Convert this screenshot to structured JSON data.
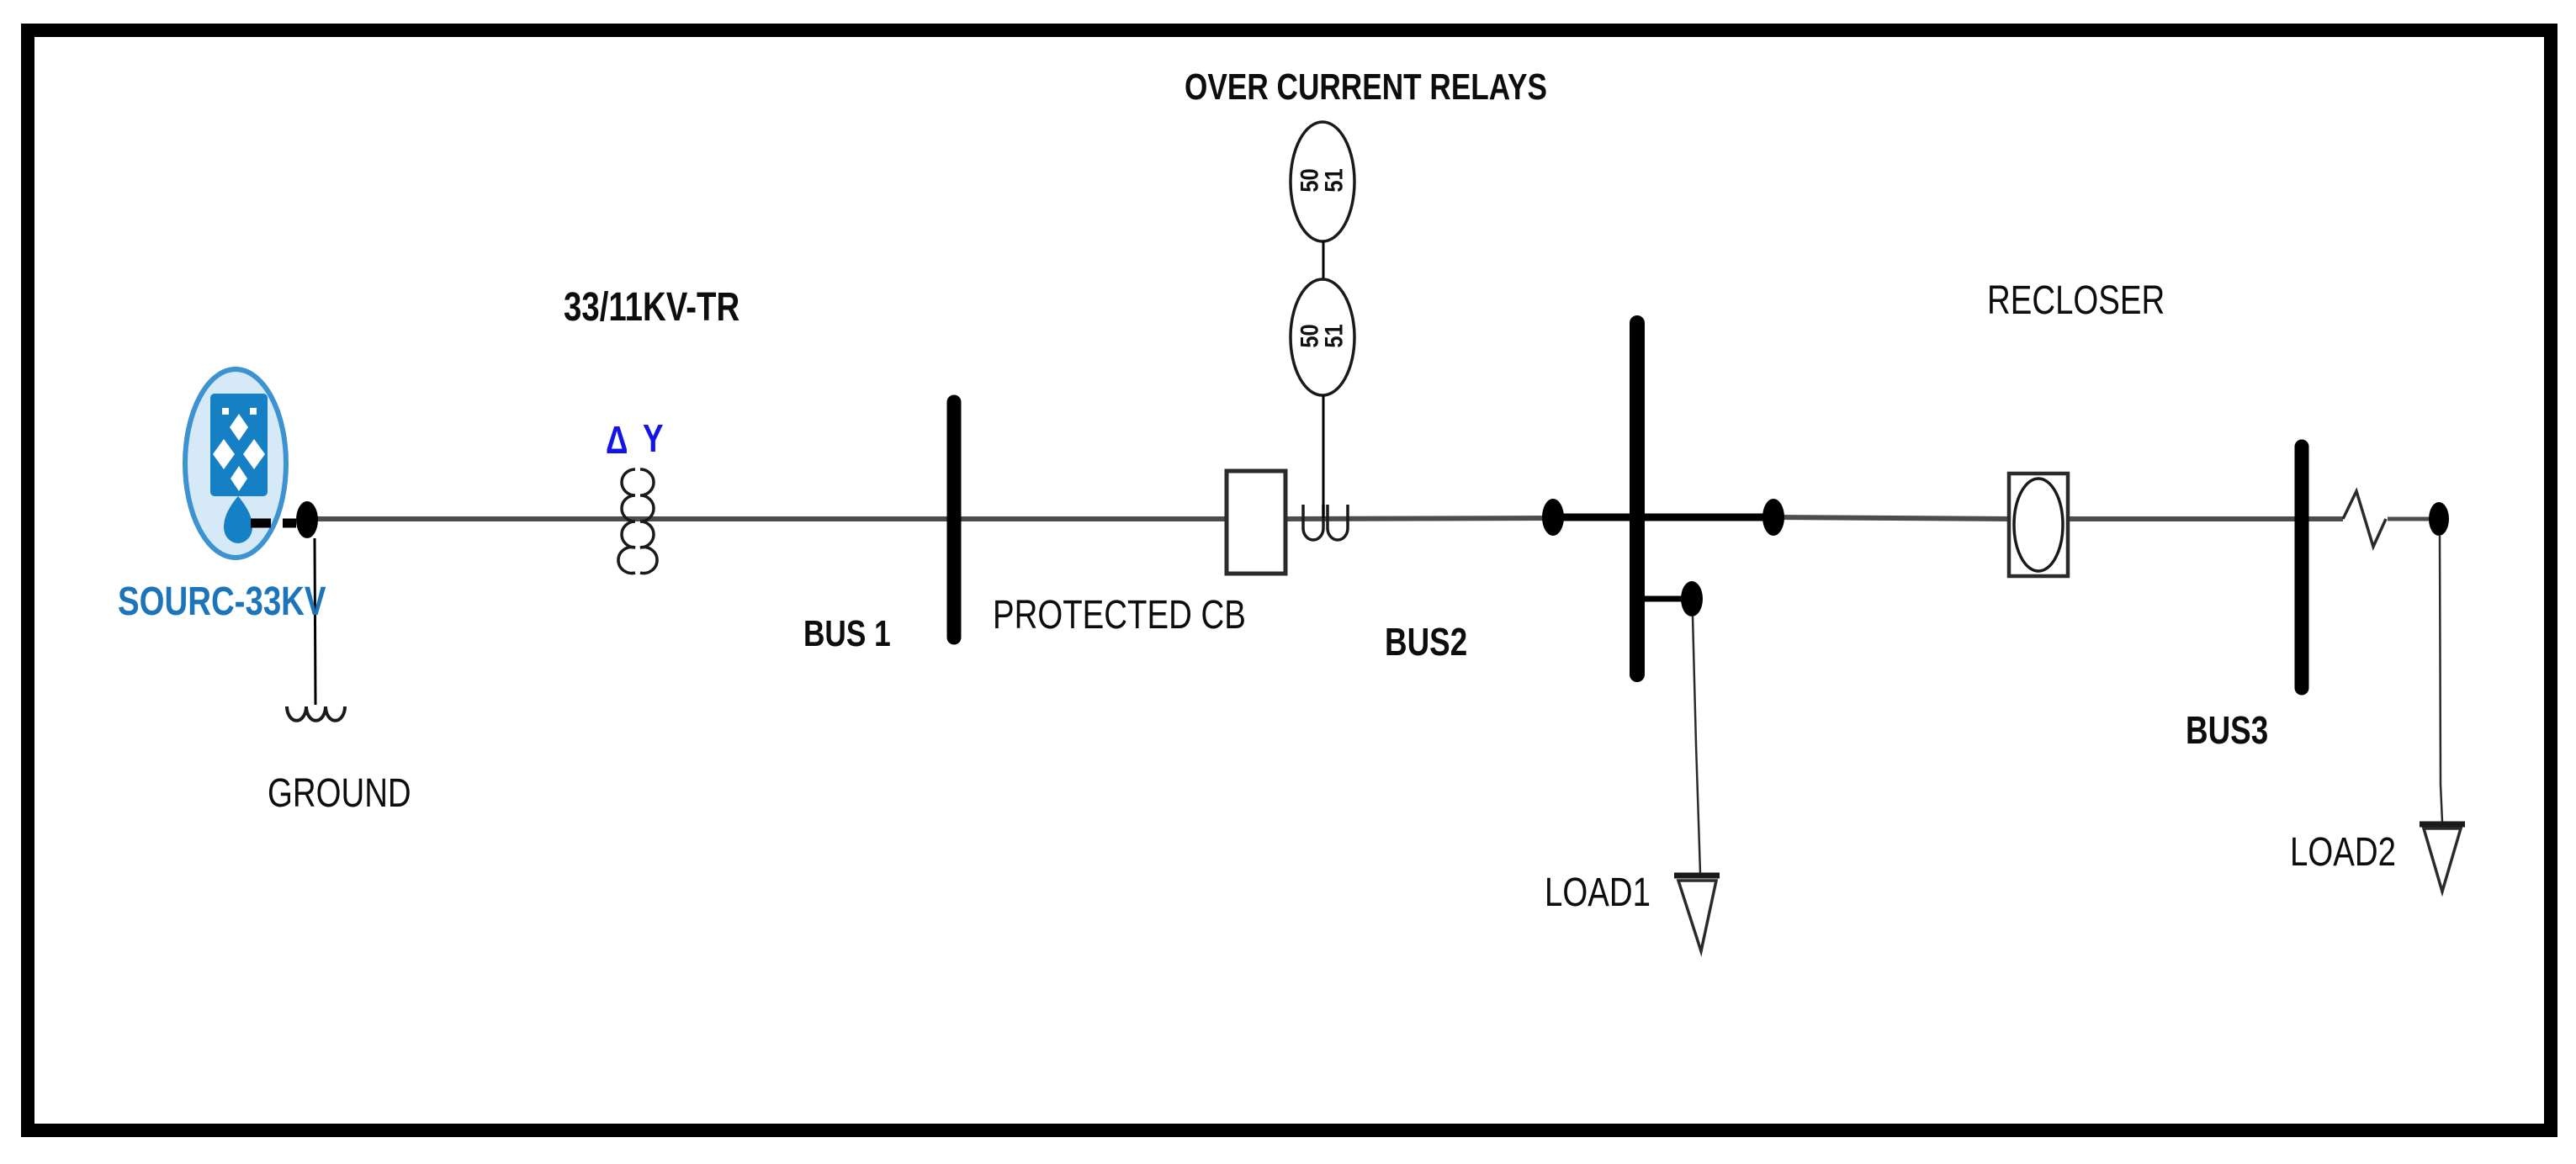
{
  "labels": {
    "source": "SOURC-33KV",
    "ground": "GROUND",
    "transformer": "33/11KV-TR",
    "bus1": "BUS 1",
    "protected_cb": "PROTECTED CB",
    "over_current_relays": "OVER CURRENT RELAYS",
    "bus2": "BUS2",
    "load1": "LOAD1",
    "recloser": "RECLOSER",
    "bus3": "BUS3",
    "load2": "LOAD2"
  },
  "symbols": {
    "delta": "Δ",
    "wye": "Y",
    "relay_top": {
      "line1": "50",
      "line2": "51"
    },
    "relay_bottom": {
      "line1": "50",
      "line2": "51"
    }
  },
  "colors": {
    "label_blue": "#1c75bb",
    "symbol_blue": "#1414e6",
    "line_gray": "#4d4d4d",
    "source_fill": "#d6e9f6",
    "source_stroke": "#3c93d0",
    "source_core": "#1580c4",
    "black": "#000000"
  }
}
